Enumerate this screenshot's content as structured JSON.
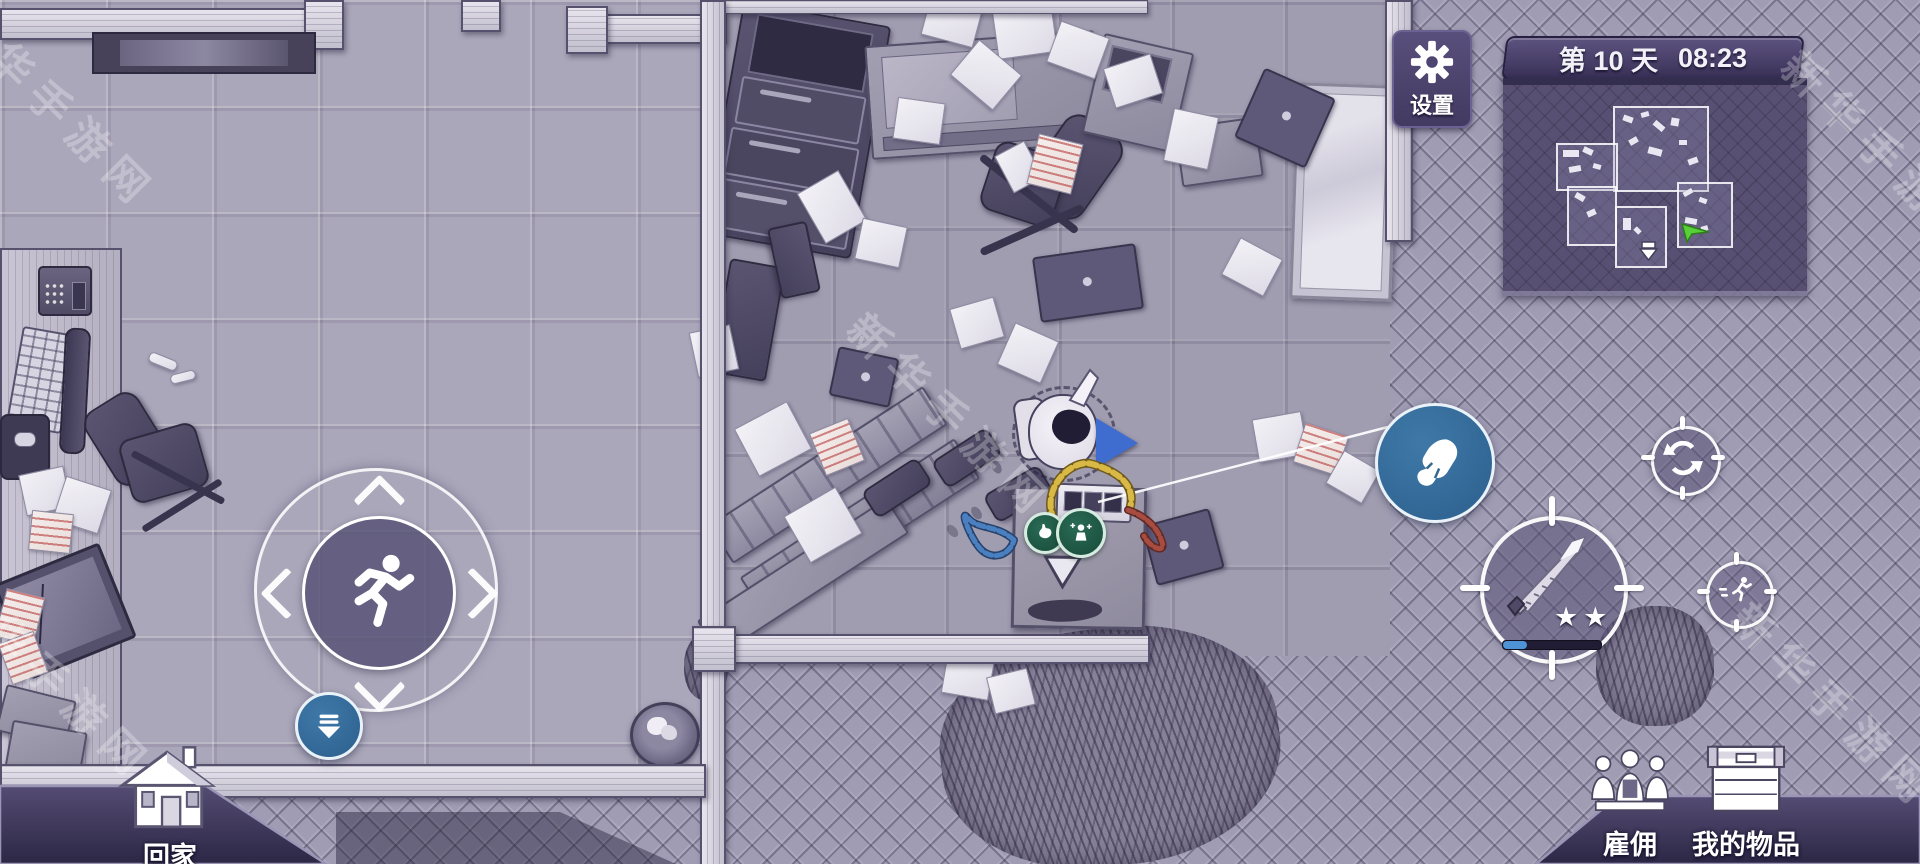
{
  "hud": {
    "settings_button": {
      "label": "设置",
      "icon": "gear-icon"
    },
    "day_time_bar": {
      "day": "第 10 天",
      "time": "08:23"
    },
    "minimap": {
      "player_marker_color": "#57cf38"
    },
    "joystick": {
      "center_icon": "runner-icon"
    },
    "grab_button": {
      "icon": "hand-grab-icon"
    },
    "pickup_button": {
      "icon": "collect-arrow-icon"
    },
    "switch_button": {
      "icon": "swap-arrows-icon"
    },
    "sprint_button": {
      "icon": "runner-icon"
    },
    "attack_button": {
      "icon": "knife-icon",
      "stars": "★★",
      "durability_percent": 24
    },
    "home_button": {
      "label": "回家",
      "icon": "house-icon"
    },
    "hire_button": {
      "label": "雇佣",
      "icon": "people-icon"
    },
    "my_items_button": {
      "label": "我的物品",
      "icon": "chest-icon"
    }
  },
  "scene": {
    "status_icons": [
      "stomach-icon",
      "poison-icon"
    ]
  },
  "watermark": {
    "text": "新华手游网"
  },
  "colors": {
    "hud_panel_purple": "#4c4470",
    "day_bar_purple": "#463c66",
    "action_button_blue": "#34688f",
    "progress_fill_blue": "#4e93d6",
    "minimap_player_green": "#57cf38",
    "flag_blue": "#3f6ccf",
    "cable_yellow": "#d9b945",
    "cable_blue": "#4a7fc0",
    "cable_red": "#a84b40"
  }
}
